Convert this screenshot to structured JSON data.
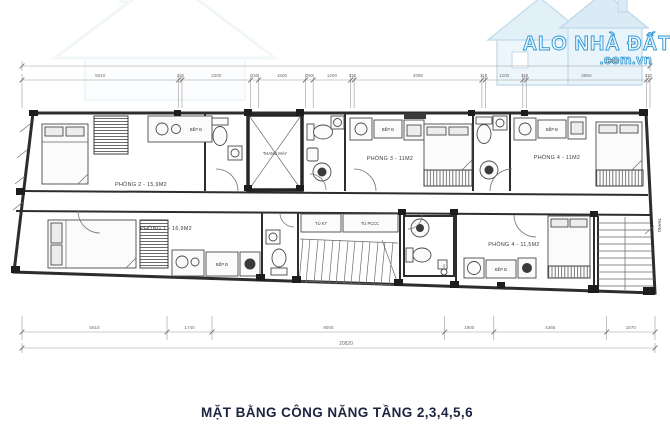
{
  "title": "MẶT BẰNG CÔNG NĂNG TẦNG 2,3,4,5,6",
  "logo": {
    "brand": "ALO NHÀ ĐẤT",
    "domain": ".com.vn"
  },
  "dimensions": {
    "top": {
      "total": "20086",
      "segments": [
        "5010",
        "110",
        "2200",
        "250",
        "1500",
        "250",
        "1200",
        "110",
        "4090",
        "110",
        "1200",
        "110",
        "3850",
        "110"
      ]
    },
    "bottom": {
      "total": "20820",
      "segments": [
        "5610",
        "1740",
        "9000",
        "1900",
        "4365",
        "1870"
      ]
    }
  },
  "labels": {
    "room2": "PHÒNG 2 - 15,9M2",
    "room3": "PHÒNG 3 - 11M2",
    "room4_top": "PHÒNG 4 - 11M2",
    "room1": "PHÒNG 1 - 16,9M2",
    "room4_bottom": "PHÒNG 4 - 11,5M2",
    "elevator": "THANG MÁY",
    "stairs": "THANG",
    "cabinet_kt": "TỦ KT",
    "cabinet_pccc": "TỦ PCCC",
    "kitchen": "BẾP Đ"
  },
  "colors": {
    "logo_blue": "#2e96d5",
    "title_navy": "#1c2440",
    "wall": "#2d2d2d"
  }
}
